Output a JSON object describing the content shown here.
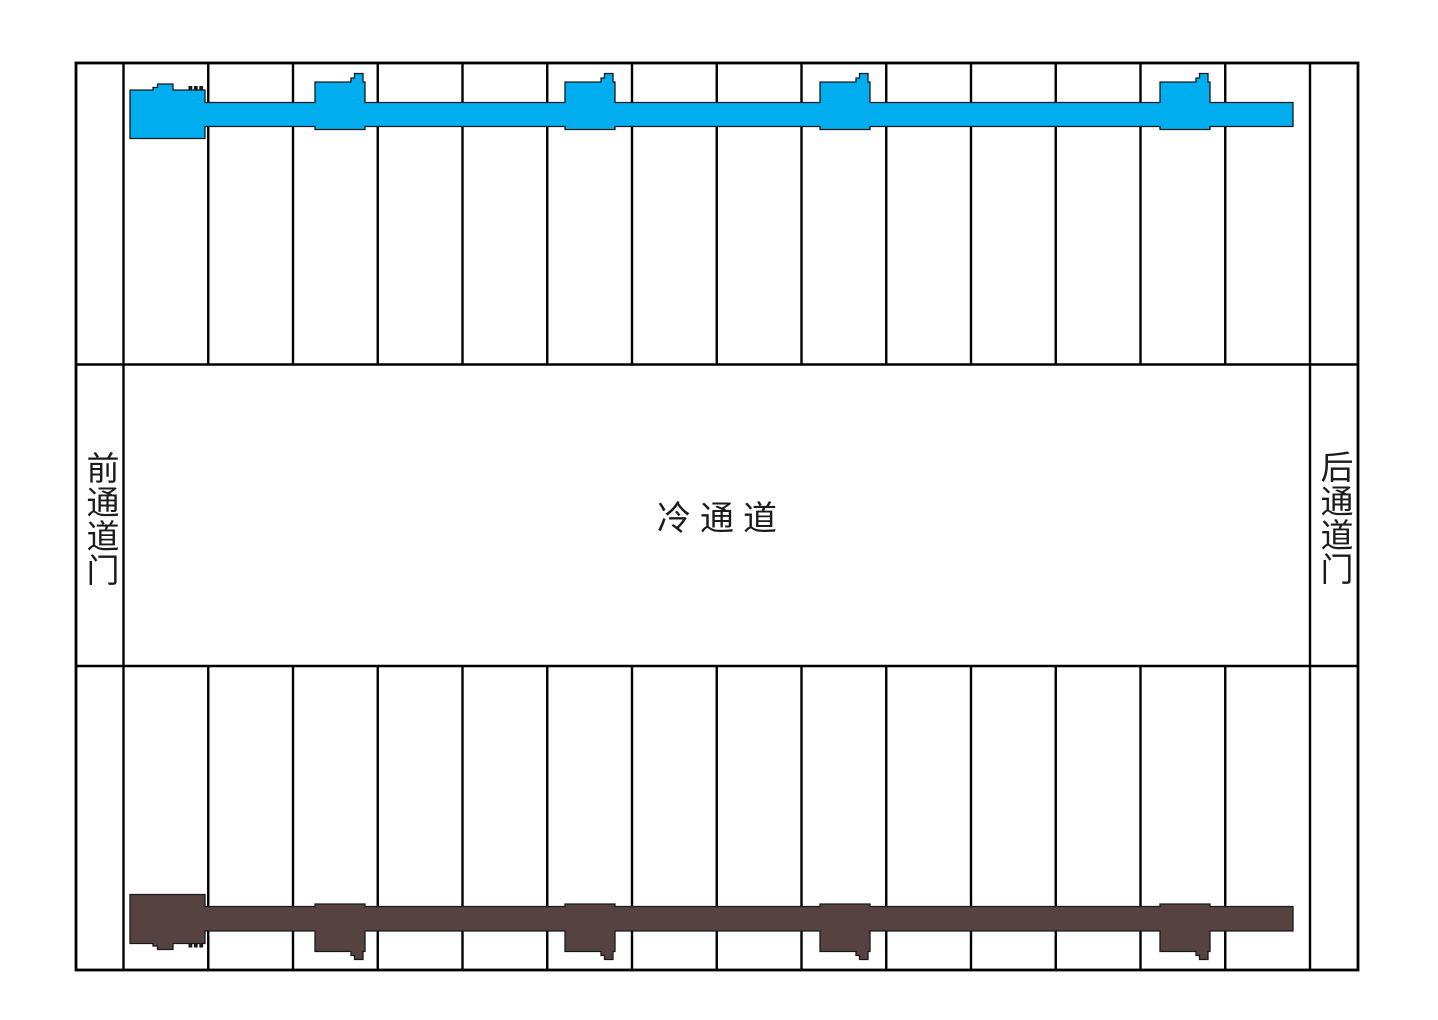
{
  "labels": {
    "front_door": "前通道门",
    "cold_aisle": "冷通道",
    "rear_door": "后通道门"
  },
  "colors": {
    "top_busbar": "#00AEEF",
    "bottom_busbar": "#564241"
  },
  "structure": {
    "rack_rows": 2,
    "rack_cells_per_row": 14,
    "busbar_feed_units_per_row": 1,
    "busbar_plug_in_boxes_per_row": 4
  }
}
